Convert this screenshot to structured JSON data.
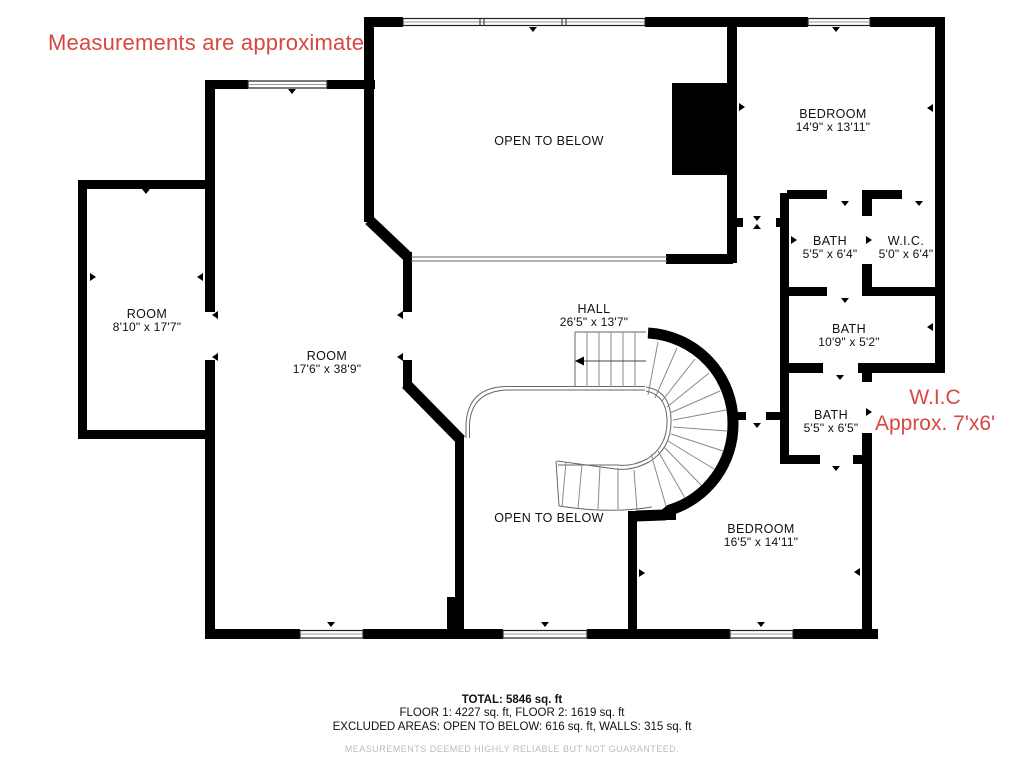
{
  "annotations": {
    "measurements_note": "Measurements are approximate",
    "wic_note_line1": "W.I.C",
    "wic_note_line2": "Approx. 7'x6'"
  },
  "rooms": [
    {
      "id": "open-to-below-1",
      "name": "OPEN TO BELOW",
      "dims": ""
    },
    {
      "id": "bedroom-1",
      "name": "BEDROOM",
      "dims": "14'9\" x 13'11\""
    },
    {
      "id": "bath-1",
      "name": "BATH",
      "dims": "5'5\" x 6'4\""
    },
    {
      "id": "wic-1",
      "name": "W.I.C.",
      "dims": "5'0\" x 6'4\""
    },
    {
      "id": "bath-2",
      "name": "BATH",
      "dims": "10'9\" x 5'2\""
    },
    {
      "id": "bath-3",
      "name": "BATH",
      "dims": "5'5\" x 6'5\""
    },
    {
      "id": "room-1",
      "name": "ROOM",
      "dims": "8'10\" x 17'7\""
    },
    {
      "id": "room-2",
      "name": "ROOM",
      "dims": "17'6\" x 38'9\""
    },
    {
      "id": "hall",
      "name": "HALL",
      "dims": "26'5\" x 13'7\""
    },
    {
      "id": "open-to-below-2",
      "name": "OPEN TO BELOW",
      "dims": ""
    },
    {
      "id": "bedroom-2",
      "name": "BEDROOM",
      "dims": "16'5\" x 14'11\""
    }
  ],
  "footer": {
    "total": "TOTAL: 5846 sq. ft",
    "floors": "FLOOR 1: 4227 sq. ft, FLOOR 2: 1619 sq. ft",
    "excluded": "EXCLUDED AREAS: OPEN TO BELOW: 616 sq. ft, WALLS: 315 sq. ft",
    "disclaimer": "MEASUREMENTS DEEMED HIGHLY RELIABLE BUT NOT GUARANTEED."
  },
  "colors": {
    "wall_black": "#000000",
    "annotation_red": "#d84742",
    "disclaimer_gray": "#bcbcbc",
    "thin_line_gray": "#666666",
    "tread_gray": "#8a8a8a"
  }
}
